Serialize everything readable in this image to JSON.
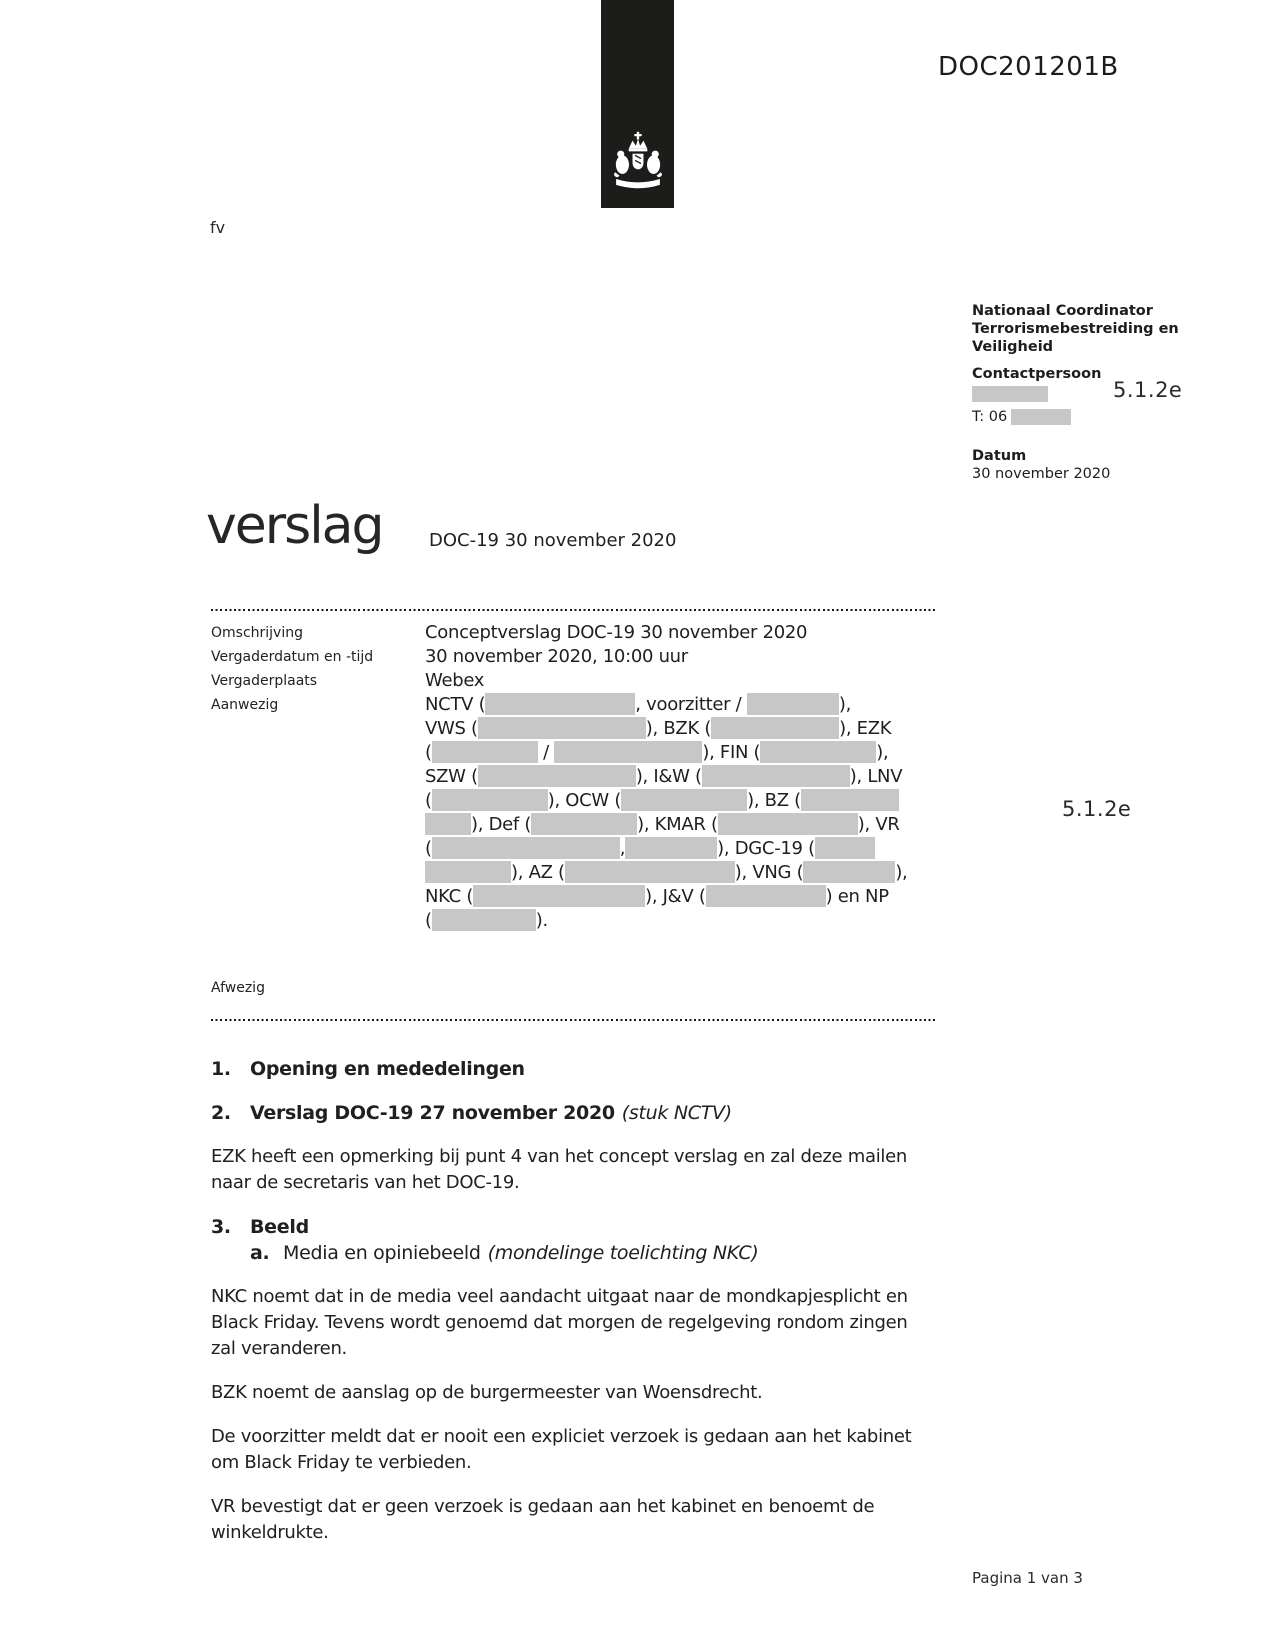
{
  "doc_id": "DOC201201B",
  "page_note": "fv",
  "colors": {
    "banner": "#1c1c1a",
    "redaction": "#c7c7c7",
    "text": "#1f1f1f"
  },
  "sidebar": {
    "org": "Nationaal Coordinator\nTerrorismebestreiding en\nVeiligheid",
    "contact_label": "Contactpersoon",
    "contact_redaction_code": "5.1.2e",
    "phone_prefix": "T: 06",
    "datum_label": "Datum",
    "datum_value": "30 november 2020"
  },
  "title": {
    "main": "verslag",
    "subtitle": "DOC-19 30 november 2020"
  },
  "meta": {
    "rows": [
      {
        "label": "Omschrijving",
        "value": "Conceptverslag DOC-19 30 november 2020"
      },
      {
        "label": "Vergaderdatum en -tijd",
        "value": "30 november 2020, 10:00 uur"
      },
      {
        "label": "Vergaderplaats",
        "value": "Webex"
      }
    ],
    "aanwezig_label": "Aanwezig",
    "aanwezig_redaction_code": "5.1.2e",
    "afwezig_label": "Afwezig",
    "aanwezig_lines": [
      {
        "segments": [
          {
            "t": "NCTV ("
          },
          {
            "r": 150
          },
          {
            "t": ", voorzitter / "
          },
          {
            "r": 92
          },
          {
            "t": "),"
          }
        ]
      },
      {
        "segments": [
          {
            "t": "VWS ("
          },
          {
            "r": 168
          },
          {
            "t": "), BZK ("
          },
          {
            "r": 128
          },
          {
            "t": "), EZK"
          }
        ]
      },
      {
        "segments": [
          {
            "t": "("
          },
          {
            "r": 106
          },
          {
            "t": " / "
          },
          {
            "r": 148
          },
          {
            "t": "), FIN ("
          },
          {
            "r": 116
          },
          {
            "t": "),"
          }
        ]
      },
      {
        "segments": [
          {
            "t": "SZW ("
          },
          {
            "r": 158
          },
          {
            "t": "), I&W ("
          },
          {
            "r": 148
          },
          {
            "t": "), LNV"
          }
        ]
      },
      {
        "segments": [
          {
            "t": "("
          },
          {
            "r": 116
          },
          {
            "t": "), OCW ("
          },
          {
            "r": 126
          },
          {
            "t": "), BZ ("
          },
          {
            "r": 98
          }
        ]
      },
      {
        "segments": [
          {
            "r": 46
          },
          {
            "t": "), Def ("
          },
          {
            "r": 106
          },
          {
            "t": "), KMAR ("
          },
          {
            "r": 140
          },
          {
            "t": "), VR"
          }
        ]
      },
      {
        "segments": [
          {
            "t": "("
          },
          {
            "r": 188
          },
          {
            "t": ","
          },
          {
            "r": 92
          },
          {
            "t": "), DGC-19 ("
          },
          {
            "r": 60
          }
        ]
      },
      {
        "segments": [
          {
            "r": 86
          },
          {
            "t": "), AZ ("
          },
          {
            "r": 170
          },
          {
            "t": "), VNG ("
          },
          {
            "r": 92
          },
          {
            "t": "),"
          }
        ]
      },
      {
        "segments": [
          {
            "t": "NKC ("
          },
          {
            "r": 172
          },
          {
            "t": "), J&V ("
          },
          {
            "r": 120
          },
          {
            "t": ") en NP"
          }
        ]
      },
      {
        "segments": [
          {
            "t": "("
          },
          {
            "r": 104
          },
          {
            "t": ")."
          }
        ]
      }
    ]
  },
  "body": {
    "blocks": [
      {
        "type": "heading",
        "num": "1.",
        "text": "Opening en mededelingen"
      },
      {
        "type": "heading",
        "num": "2.",
        "text": "Verslag DOC-19 27 november 2020",
        "italic": "(stuk NCTV)"
      },
      {
        "type": "para",
        "text": "EZK heeft een opmerking bij punt 4 van het concept verslag en zal deze mailen\nnaar de secretaris van het DOC-19."
      },
      {
        "type": "heading",
        "num": "3.",
        "text": "Beeld"
      },
      {
        "type": "subitem",
        "num": "a.",
        "text": "Media en opiniebeeld",
        "italic": "(mondelinge toelichting NKC)"
      },
      {
        "type": "para",
        "text": "NKC noemt dat in de media veel aandacht uitgaat naar de mondkapjesplicht en\nBlack Friday. Tevens wordt genoemd dat morgen de regelgeving rondom zingen\nzal veranderen."
      },
      {
        "type": "para",
        "text": "BZK noemt de aanslag op de burgermeester van Woensdrecht."
      },
      {
        "type": "para",
        "text": "De voorzitter meldt dat er nooit een expliciet verzoek is gedaan aan het kabinet\nom Black Friday te verbieden."
      },
      {
        "type": "para",
        "text": "VR bevestigt dat er geen verzoek is gedaan aan het kabinet en benoemt de\nwinkeldrukte."
      }
    ]
  },
  "footer": {
    "page": "Pagina 1 van 3"
  }
}
